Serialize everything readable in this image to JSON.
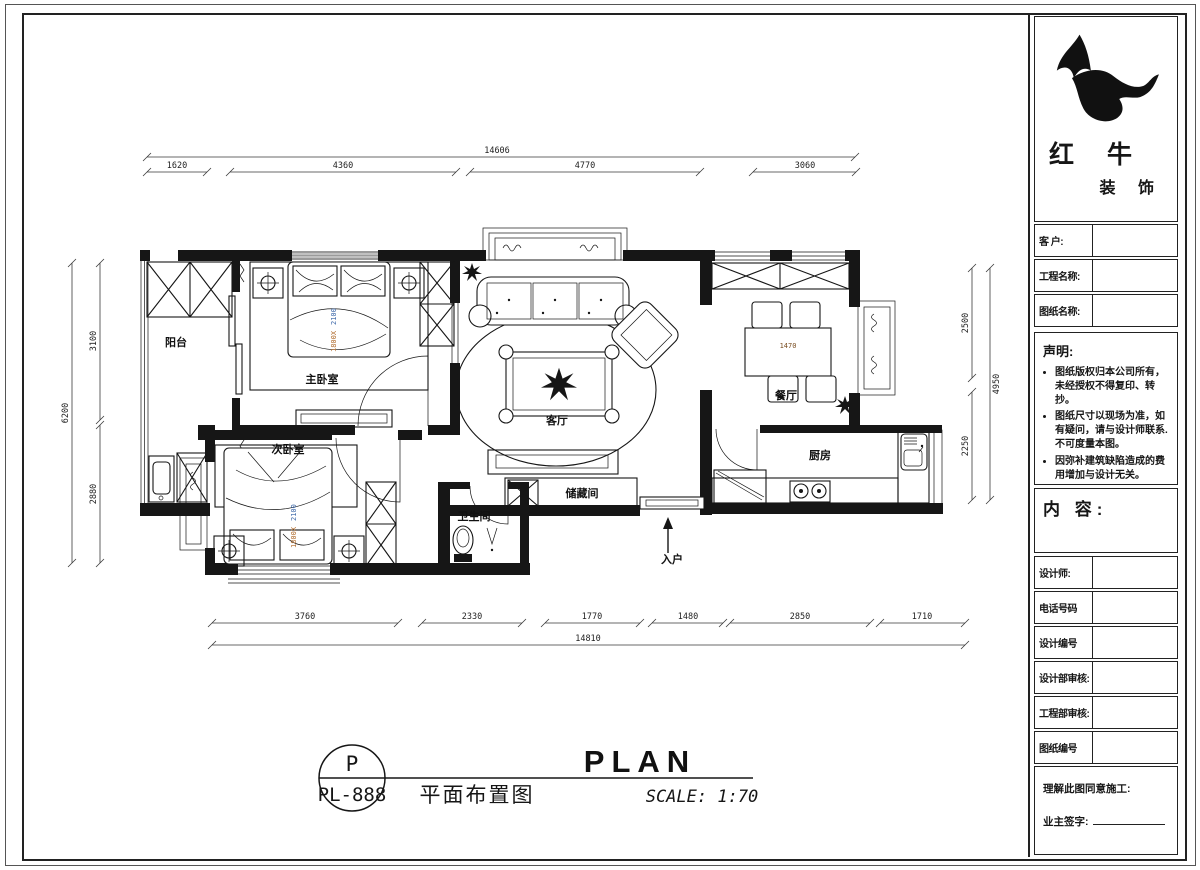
{
  "colors": {
    "ink": "#161616",
    "bed_size_orange": "#b06a2a",
    "bed_size_blue": "#3a66a8",
    "window_gray": "#9a9a9a"
  },
  "sidebar": {
    "logo": {
      "name_line1": "红 牛",
      "name_line2": "装 饰"
    },
    "fields_top": [
      {
        "label": "客  户:"
      },
      {
        "label": "工程名称:"
      },
      {
        "label": "图纸名称:"
      }
    ],
    "statement": {
      "title": "声明:",
      "items": [
        "图纸版权归本公司所有，未经授权不得复印、转抄。",
        "图纸尺寸以现场为准，如有疑问，请与设计师联系. 不可度量本图。",
        "因弥补建筑缺陷造成的费用增加与设计无关。"
      ]
    },
    "content_label": "内 容:",
    "fields_bottom": [
      {
        "label": "设计师:"
      },
      {
        "label": "电话号码"
      },
      {
        "label": "设计编号"
      },
      {
        "label": "设计部审核:"
      },
      {
        "label": "工程部审核:"
      },
      {
        "label": "图纸编号"
      }
    ],
    "footer": {
      "line1": "理解此图同意施工:",
      "line2": "业主签字:"
    }
  },
  "titleblock": {
    "code_top": "P",
    "code_bottom": "PL-888",
    "title_cn": "平面布置图",
    "title_en": "PLAN",
    "scale": "SCALE: 1:70"
  },
  "plan": {
    "rooms": [
      {
        "label": "阳台"
      },
      {
        "label": "主卧室"
      },
      {
        "label": "次卧室"
      },
      {
        "label": "卫生间"
      },
      {
        "label": "储藏间"
      },
      {
        "label": "客厅"
      },
      {
        "label": "餐厅"
      },
      {
        "label": "厨房"
      },
      {
        "label": "入户"
      }
    ],
    "annotations": {
      "bed_size_a": "1800X",
      "bed_size_b": "2100",
      "dining_table": "1470"
    },
    "dims": {
      "top": {
        "total": "14606",
        "segments": [
          "1620",
          "4360",
          "4770",
          "3060"
        ]
      },
      "bottom": {
        "total": "14810",
        "segments": [
          "3760",
          "2330",
          "1770",
          "1480",
          "2850",
          "1710"
        ]
      },
      "left": {
        "total": "6200",
        "segments": [
          "3100",
          "2880"
        ]
      },
      "right": {
        "total": "4950",
        "segments": [
          "2500",
          "2250"
        ]
      }
    }
  }
}
